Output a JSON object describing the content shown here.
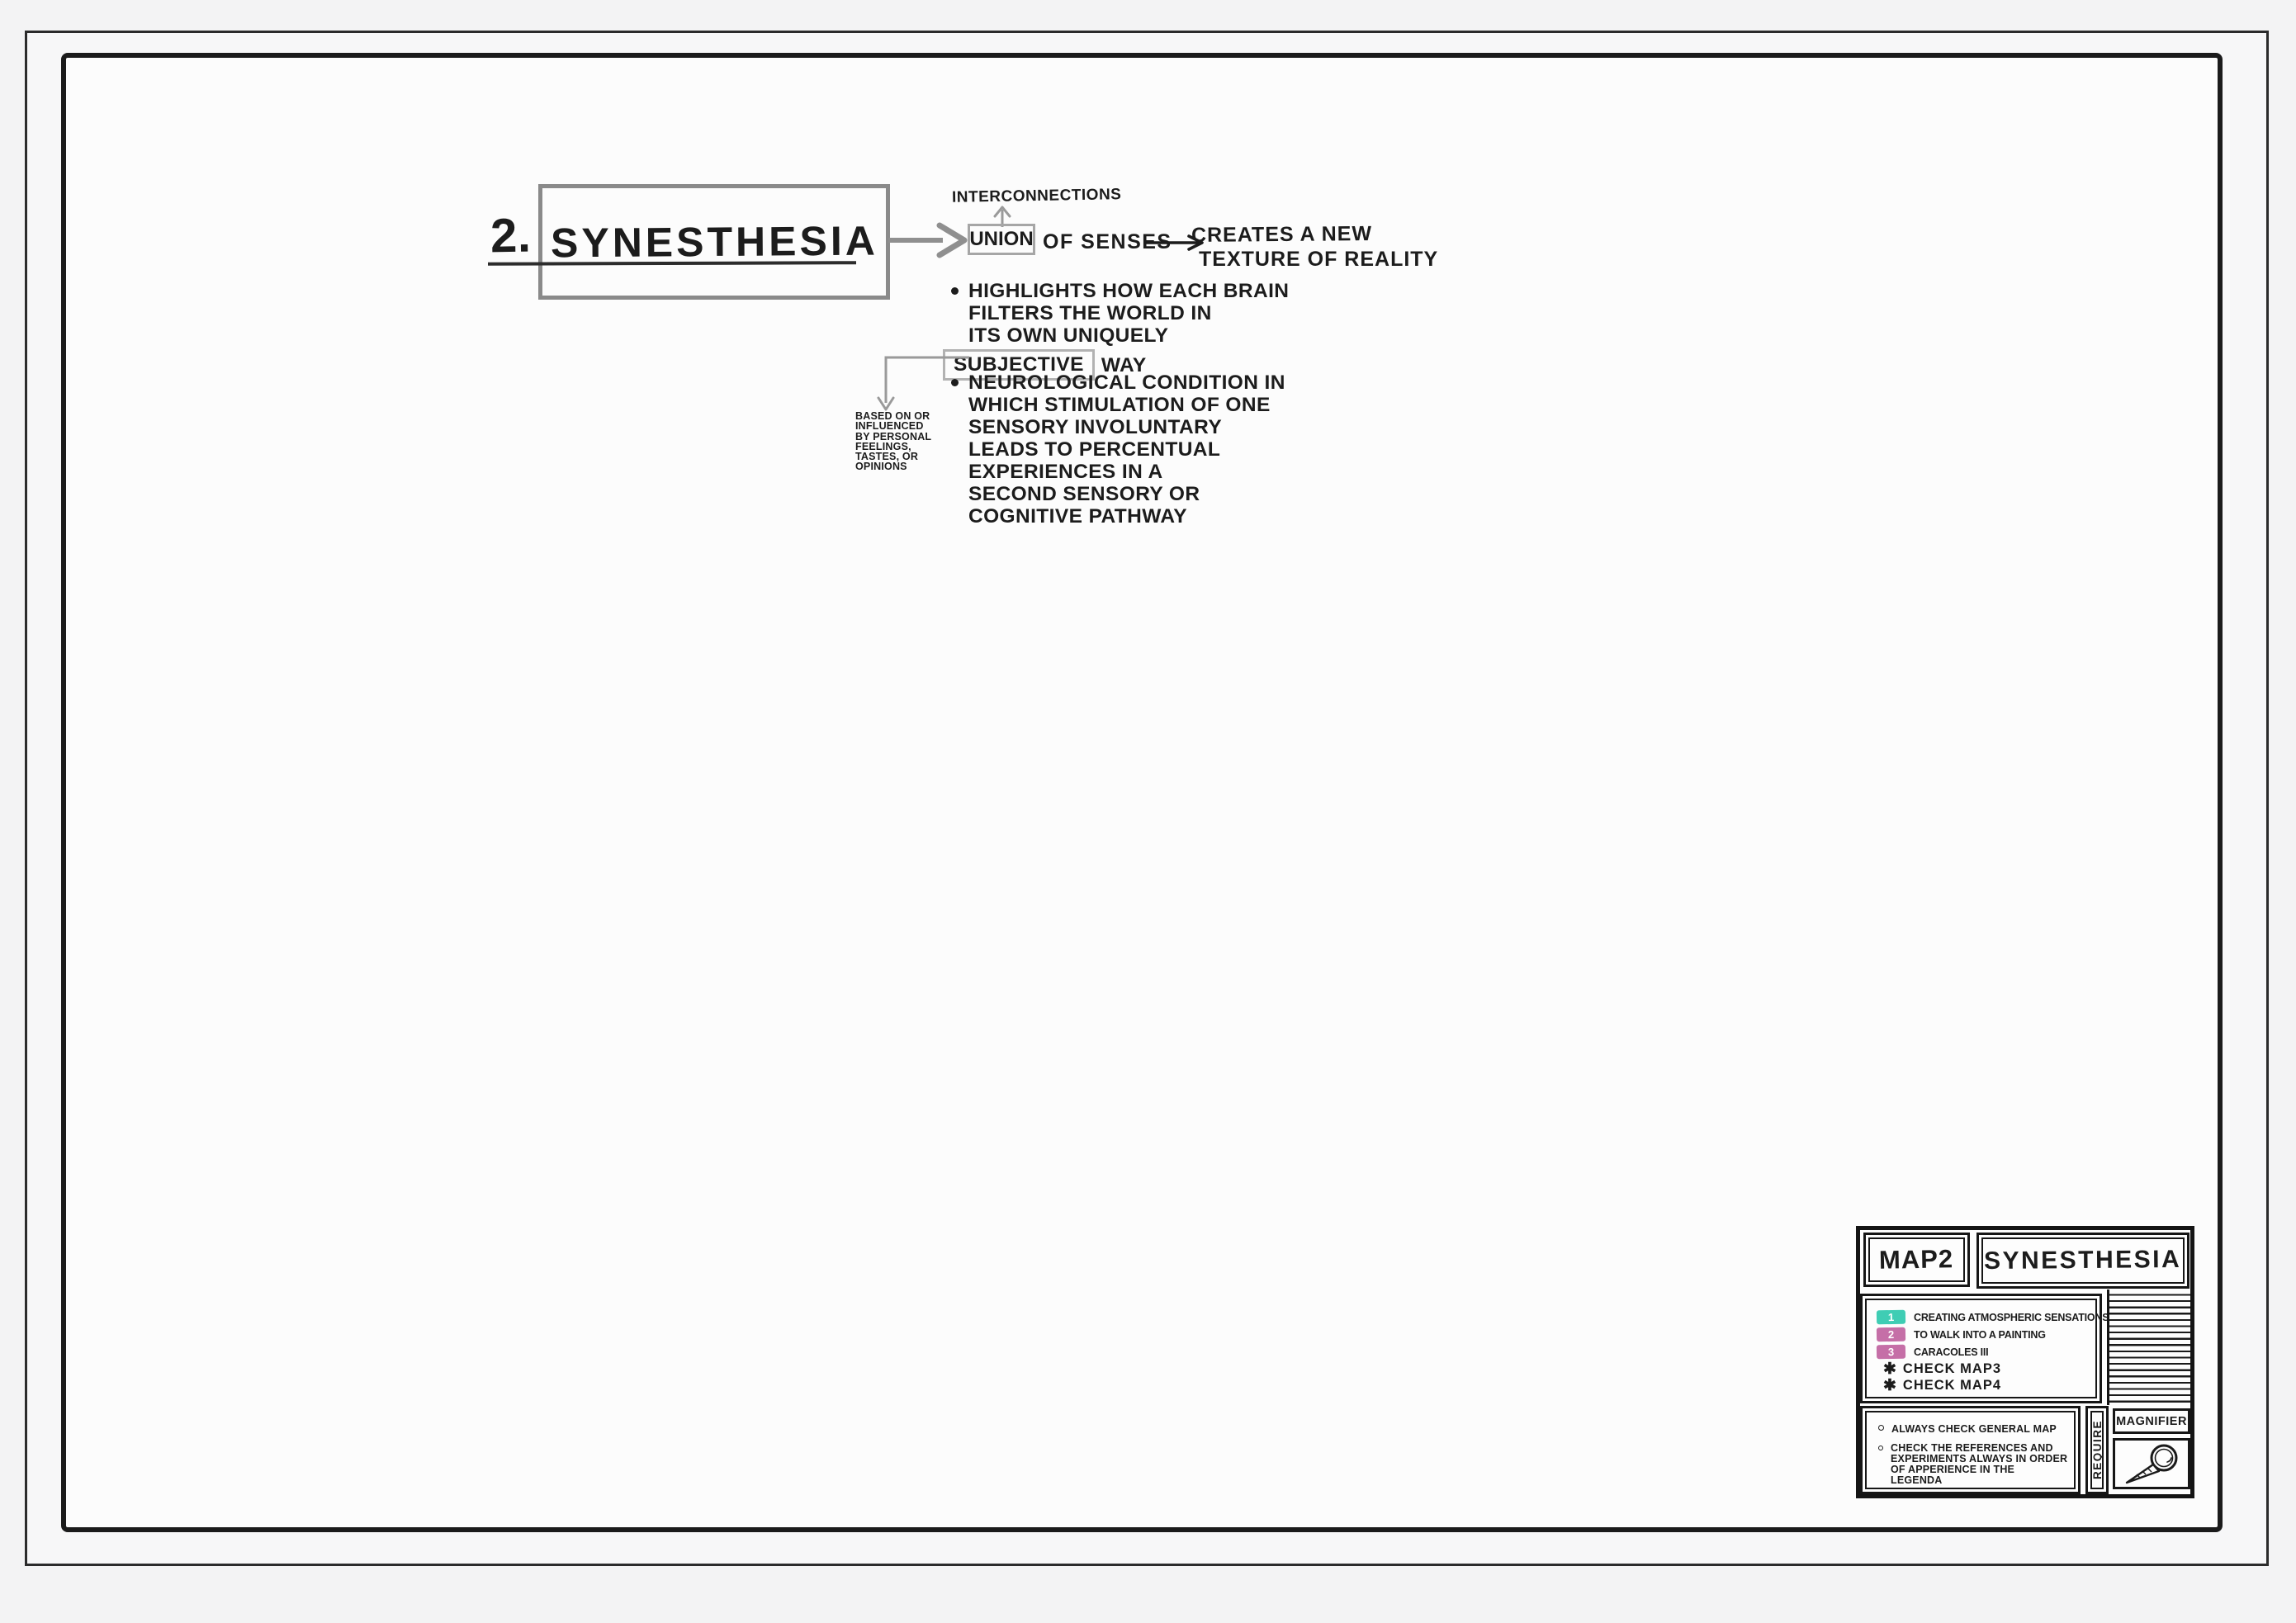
{
  "colors": {
    "ink": "#1c1c1c",
    "structure_gray": "#8f8f8f",
    "badge_teal": "#3fcdb4",
    "badge_pink": "#c56fa7",
    "canvas_bg": "#fcfcfc"
  },
  "title": {
    "number": "2.",
    "text": "SYNESTHESIA"
  },
  "diagram": {
    "interconnections": "INTERCONNECTIONS",
    "union_word": "UNION",
    "union_suffix": "OF SENSES",
    "creates_line1": "CREATES A NEW",
    "creates_line2": "TEXTURE OF REALITY",
    "bullet1_line1": "HIGHLIGHTS HOW EACH BRAIN",
    "bullet1_line2": "FILTERS THE WORLD IN",
    "bullet1_line3": "ITS OWN UNIQUELY",
    "subjective_word": "SUBJECTIVE",
    "subjective_tail": "WAY",
    "subjective_note_line1": "BASED ON OR",
    "subjective_note_line2": "INFLUENCED",
    "subjective_note_line3": "BY PERSONAL",
    "subjective_note_line4": "FEELINGS,",
    "subjective_note_line5": "TASTES, OR",
    "subjective_note_line6": "OPINIONS",
    "bullet2_line1": "NEUROLOGICAL CONDITION IN",
    "bullet2_line2": "WHICH STIMULATION OF ONE",
    "bullet2_line3": "SENSORY INVOLUNTARY",
    "bullet2_line4": "LEADS TO PERCENTUAL",
    "bullet2_line5": "EXPERIENCES IN A",
    "bullet2_line6": "SECOND SENSORY OR",
    "bullet2_line7": "COGNITIVE PATHWAY"
  },
  "legend": {
    "map_label": "MAP2",
    "map_title": "SYNESTHESIA",
    "items": [
      {
        "num": "1",
        "label": "CREATING ATMOSPHERIC SENSATIONS",
        "badge_style": "background:#3fcdb4"
      },
      {
        "num": "2",
        "label": "TO WALK INTO A PAINTING",
        "badge_style": "background:#c56fa7"
      },
      {
        "num": "3",
        "label": "CARACOLES III",
        "badge_style": "background:#c56fa7"
      }
    ],
    "checks": [
      {
        "icon": "✱",
        "label": "CHECK MAP3"
      },
      {
        "icon": "✱",
        "label": "CHECK MAP4"
      }
    ],
    "note1": "ALWAYS CHECK GENERAL MAP",
    "note2_line1": "CHECK THE REFERENCES AND",
    "note2_line2": "EXPERIMENTS ALWAYS IN ORDER",
    "note2_line3": "OF APPERIENCE IN THE LEGENDA",
    "require_label": "REQUIRE",
    "magnifier_label": "MAGNIFIER"
  }
}
